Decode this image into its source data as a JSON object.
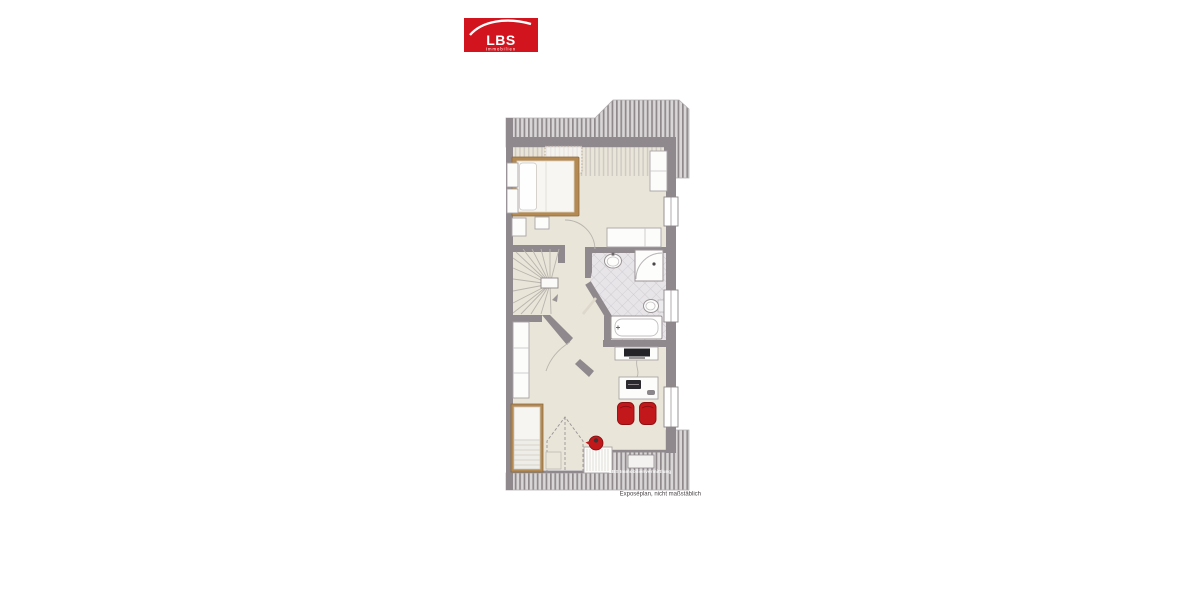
{
  "logo": {
    "brand": "LBS",
    "tagline": "Immobilien"
  },
  "floorplan": {
    "watermark": "LBS Immobilienvermittlung",
    "caption": "Exposéplan, nicht maßstäblich"
  },
  "colors": {
    "brand_red": "#d2141e",
    "chair_red": "#c2181b",
    "teapot_red": "#c2181b",
    "wall_gray": "#8f888c",
    "floor_beige": "#e9e5d8",
    "wood": "#b58a52",
    "hatch_gray": "#8f898c",
    "tile_gray": "#e7e5e8"
  }
}
